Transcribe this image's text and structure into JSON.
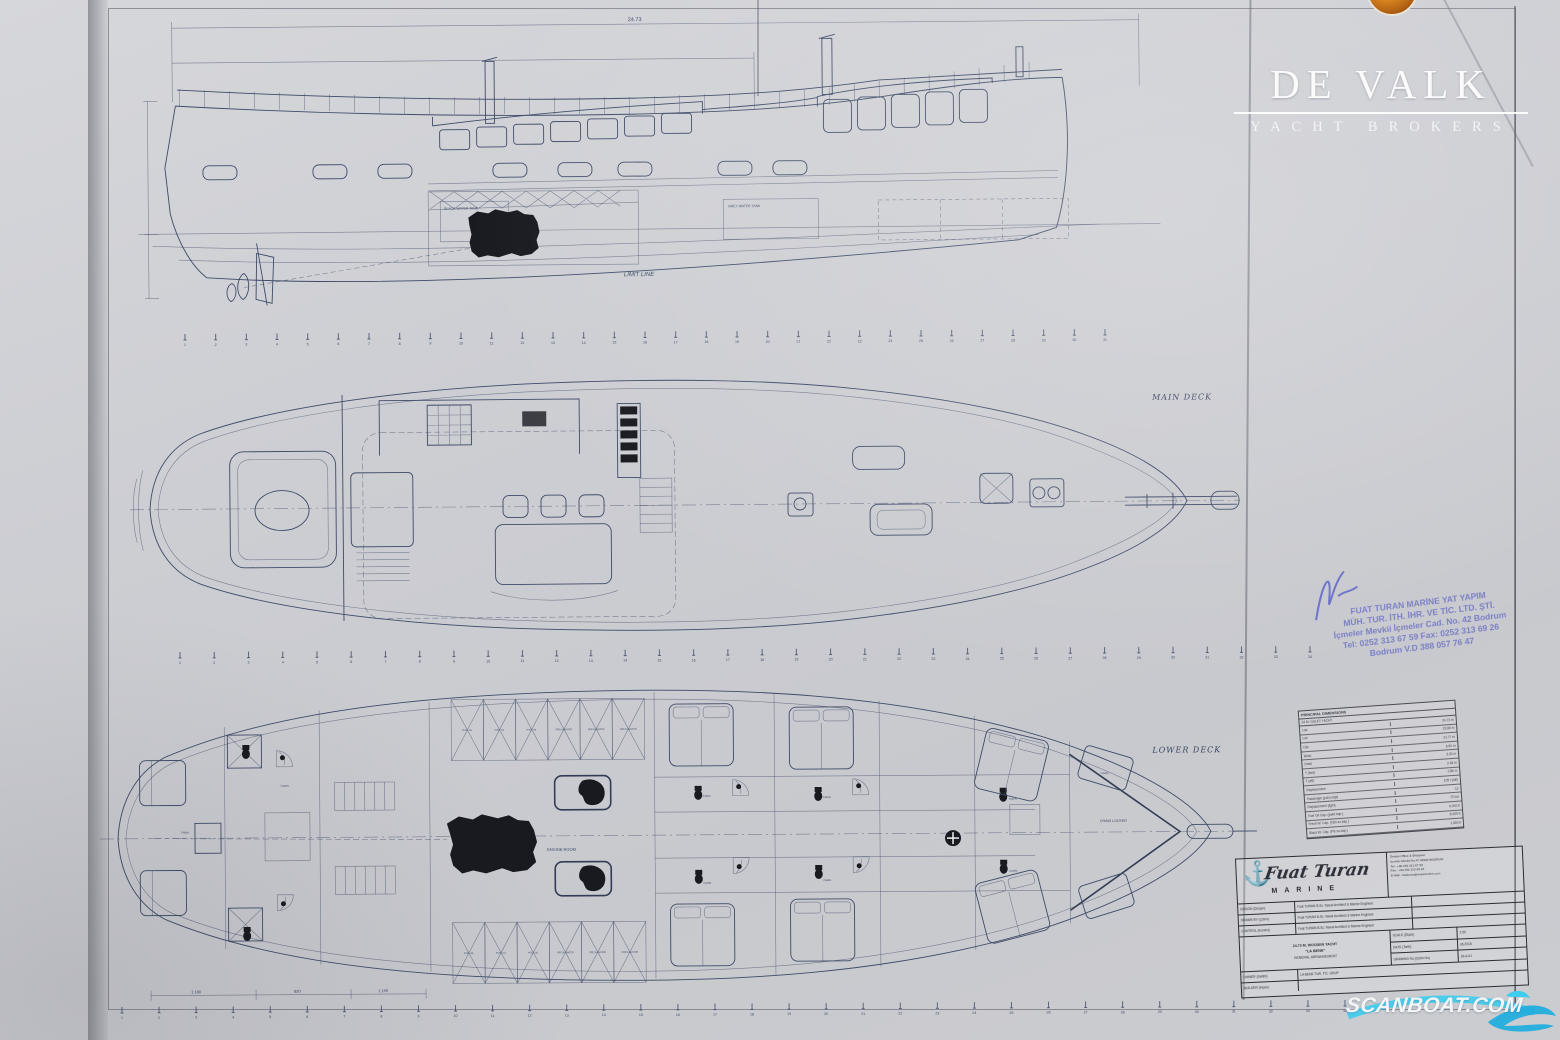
{
  "branding": {
    "logo_name": "DE VALK",
    "logo_sub": "YACHT BROKERS",
    "logo_color": "#d98a2b"
  },
  "watermark": {
    "text": "SCANBOAT.COM",
    "wave_color": "#35c6ea"
  },
  "sheet": {
    "profile": {
      "dim_top": "24.73",
      "limit_line": "LIMIT LINE",
      "black_water": "BLACK WATER TANK",
      "grey_water": "GREY WATER TANK"
    },
    "main_deck": {
      "label": "MAIN DECK"
    },
    "lower_deck": {
      "label": "LOWER DECK",
      "chain_locker": "CHAIN LOCKER",
      "engine_room": "ENGINE ROOM",
      "cabin_label": "CABIN",
      "shower_label": "SHOWER&WC",
      "tanks": [
        "FUEL OIL",
        "FUEL OIL",
        "FUEL OIL",
        "FRESH WATER",
        "FRESH WATER",
        "FRESH WATER"
      ],
      "dim_labels": [
        "1.180",
        "820",
        "1.190"
      ]
    },
    "stations": {
      "rows": [
        {
          "labels": [
            "1",
            "2",
            "3",
            "4",
            "5",
            "6",
            "7",
            "8",
            "9",
            "10",
            "11",
            "12",
            "13",
            "14",
            "15",
            "16",
            "17",
            "18",
            "19",
            "20",
            "21",
            "22",
            "23",
            "24",
            "25",
            "26",
            "27",
            "28",
            "29",
            "30",
            "31"
          ]
        },
        {
          "labels": [
            "1",
            "2",
            "3",
            "4",
            "5",
            "6",
            "7",
            "8",
            "9",
            "10",
            "11",
            "12",
            "13",
            "14",
            "15",
            "16",
            "17",
            "18",
            "19",
            "20",
            "21",
            "22",
            "23",
            "24",
            "25",
            "26",
            "27",
            "28",
            "29",
            "30",
            "31",
            "32",
            "33",
            "34"
          ]
        },
        {
          "labels": [
            "1",
            "2",
            "3",
            "4",
            "5",
            "6",
            "7",
            "8",
            "9",
            "10",
            "11",
            "12",
            "13",
            "14",
            "15",
            "16",
            "17",
            "18",
            "19",
            "20",
            "21",
            "22",
            "23",
            "24",
            "25",
            "26",
            "27",
            "28",
            "29",
            "30",
            "31",
            "32",
            "33",
            "34"
          ]
        }
      ]
    }
  },
  "stamp": {
    "color": "#7477c4",
    "lines": [
      "FUAT TURAN MARİNE YAT YAPIM",
      "MÜH. TUR. İTH. İHR. VE TİC. LTD. ŞTİ.",
      "İçmeler Mevkii İçmeler Cad. No. 42 Bodrum",
      "Tel: 0252 313 67 59 Fax: 0252 313 69 26",
      "Bodrum V.D 388 057 76 47"
    ]
  },
  "dimensions_table": {
    "title": "PRINCIPAL DIMENSIONS",
    "subtitle": "24 M. GULET YACHT",
    "rows": [
      [
        "Loa",
        "24.73 m"
      ],
      [
        "Lwl",
        "23.08 m"
      ],
      [
        "Lbp",
        "21.77 m"
      ],
      [
        "Bmld",
        "6.50 m"
      ],
      [
        "Dmld",
        "3.30 m"
      ],
      [
        "T (fwd)",
        "2.45 m"
      ],
      [
        "T (aft)",
        "2.85 m"
      ],
      [
        "Displacement",
        "105 t (full)"
      ],
      [
        "Passenger (yolcu kişi)",
        "12"
      ],
      [
        "Displacement (light)",
        "72 ton"
      ],
      [
        "Fuel Oil Cap. (yakıt kap.)",
        "6.000 lt"
      ],
      [
        "Fresh W. Cap. (Tatlı su kap.)",
        "8.000 lt"
      ],
      [
        "Black W. Cap. (Pis su kap.)",
        "1.500 lt"
      ]
    ]
  },
  "title_block": {
    "company_script": "Fuat Turan",
    "company_sub": "MARINE",
    "anchor_icon": "⚓",
    "office_lines": [
      "Design Office & Shipyard",
      "İçmeler Mevkii No:47 48400 BODRUM",
      "Tel : +90 252 313 67 59",
      "Fax : +90 252 313 69 26",
      "E-Mail : fuatturan@superonline.com"
    ],
    "rows": [
      [
        "DESIGN (Dizayn)",
        "Fuat TURAN B.Sc. Naval Architect & Marine Engineer"
      ],
      [
        "DRAWN BY (Çizen)",
        "Fuat TURAN B.Sc. Naval Architect & Marine Engineer"
      ],
      [
        "CONTROL (Kontrol)",
        "Fuat TURAN B.Sc. Naval Architect & Marine Engineer"
      ]
    ],
    "project_lines": [
      "24.73 M. WOODEN YACHT",
      "\"LA BENE\"",
      "GENERAL ARRANGEMENT"
    ],
    "meta": [
      [
        "SCALE (Ölçek)",
        "1:50"
      ],
      [
        "DATE (Tarih)",
        "06.2018"
      ],
      [
        "DRAWING No (Çizim No)",
        "18-A-01"
      ]
    ],
    "bottom": [
      [
        "OWNER (Sahibi)",
        "LA BENE TUR. TİC. GRUP"
      ],
      [
        "BUILDER (İnşacı)",
        ""
      ]
    ]
  }
}
